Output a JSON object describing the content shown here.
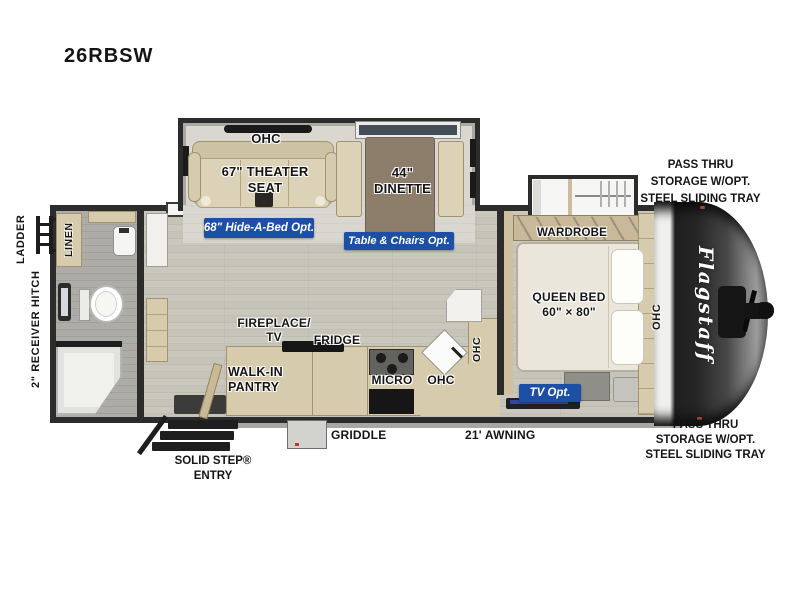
{
  "title": "26RBSW",
  "brand": "Flagstaff",
  "ext": {
    "pass_top": [
      "PASS THRU",
      "STORAGE W/OPT.",
      "STEEL SLIDING TRAY"
    ],
    "pass_bottom": [
      "PASS THRU",
      "STORAGE W/OPT.",
      "STEEL SLIDING TRAY"
    ],
    "ladder": "LADDER",
    "hitch": "2\" RECEIVER HITCH",
    "step": [
      "SOLID STEP®",
      "ENTRY"
    ],
    "griddle": "GRIDDLE",
    "awning": "21' AWNING"
  },
  "room": {
    "ohc_lounge": "OHC",
    "theater": [
      "67\" THEATER",
      "SEAT"
    ],
    "dinette": [
      "44\"",
      "DINETTE"
    ],
    "linen": "LINEN",
    "wardrobe": "WARDROBE",
    "bed": [
      "QUEEN BED",
      "60\" × 80\""
    ],
    "ohc_bed": "OHC",
    "fireplace": [
      "FIREPLACE/",
      "TV"
    ],
    "fridge": "FRIDGE",
    "pantry": [
      "WALK-IN",
      "PANTRY"
    ],
    "micro": "MICRO",
    "ohc_kitchen": "OHC",
    "ohc_corner": "OHC"
  },
  "opt": {
    "hide_a_bed": "68\" Hide-A-Bed Opt.",
    "table_chairs": "Table & Chairs Opt.",
    "tv": "TV Opt."
  },
  "colors": {
    "option_badge_blue": "#1c4fa5",
    "wall_dark": "#2c2c2c",
    "cabinet_tan": "#d7cbae",
    "dinette_table_brown": "#8d7e6b",
    "floor_wood": "#c6c4b8",
    "slide_floor": "#d9d7d0",
    "front_cap_dark": "#262626"
  }
}
